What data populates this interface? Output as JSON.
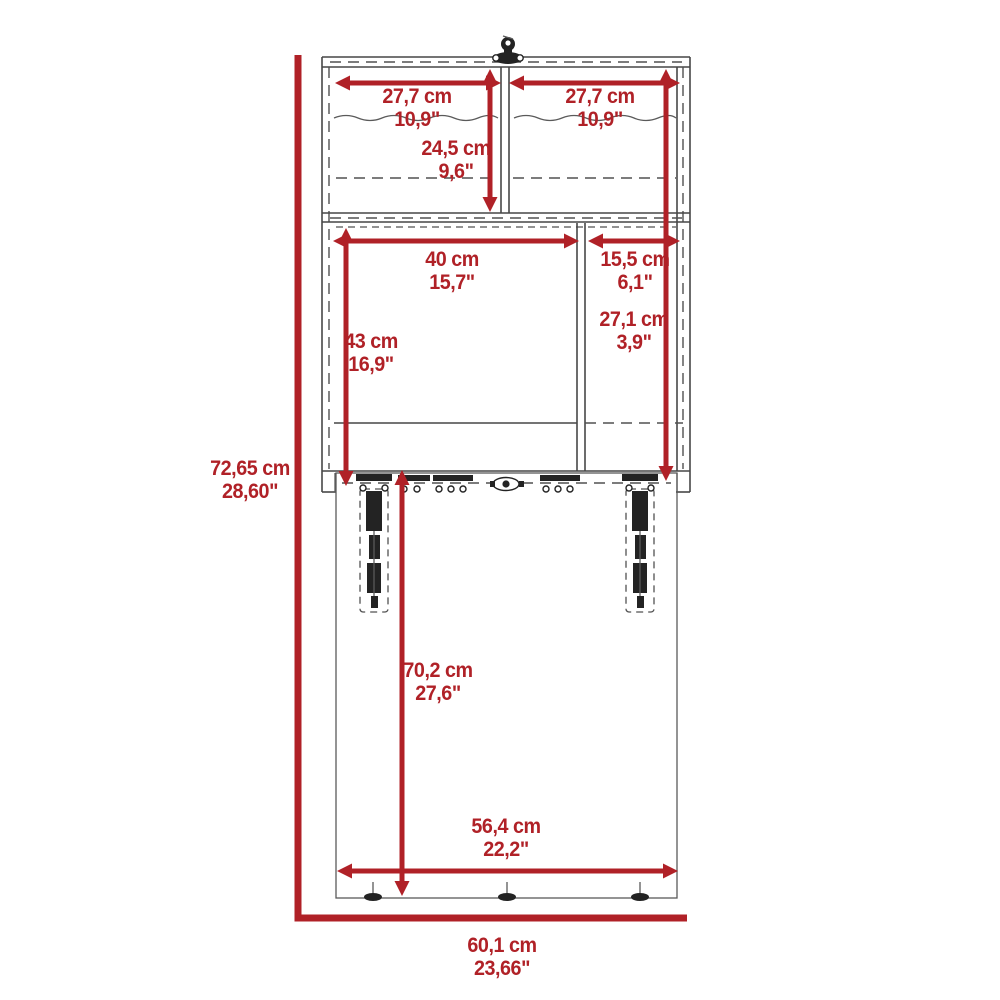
{
  "diagram_title": "fold-down desk cabinet dimension drawing",
  "colors": {
    "accent": "#b02127",
    "line": "#474747"
  },
  "units": [
    "cm",
    "inch"
  ],
  "labels": [
    {
      "id": "top-left-compartment-width",
      "cm": "27,7 cm",
      "inch": "10,9\""
    },
    {
      "id": "top-right-compartment-width",
      "cm": "27,7 cm",
      "inch": "10,9\""
    },
    {
      "id": "upper-compartment-height",
      "cm": "24,5 cm",
      "inch": "9,6\""
    },
    {
      "id": "middle-left-width",
      "cm": "40 cm",
      "inch": "15,7\""
    },
    {
      "id": "middle-right-width",
      "cm": "15,5 cm",
      "inch": "6,1\""
    },
    {
      "id": "middle-left-height",
      "cm": "43 cm",
      "inch": "16,9\""
    },
    {
      "id": "middle-right-height",
      "cm": "27,1 cm",
      "inch": "3,9\""
    },
    {
      "id": "overall-height",
      "cm": "72,65 cm",
      "inch": "28,60\""
    },
    {
      "id": "door-panel-height",
      "cm": "70,2 cm",
      "inch": "27,6\""
    },
    {
      "id": "door-panel-width",
      "cm": "56,4 cm",
      "inch": "22,2\""
    },
    {
      "id": "overall-width",
      "cm": "60,1 cm",
      "inch": "23,66\""
    }
  ]
}
